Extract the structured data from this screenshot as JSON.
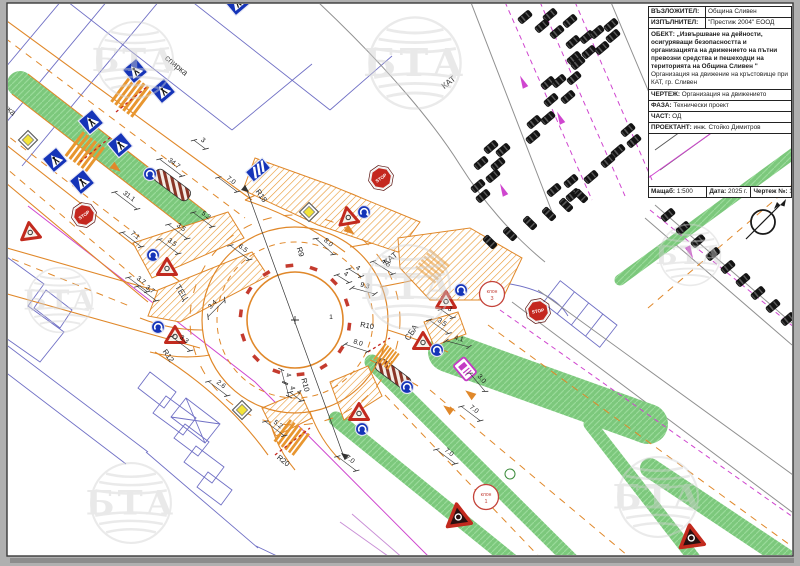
{
  "title_block": {
    "rows": [
      {
        "label": "ВЪЗЛОЖИТЕЛ:",
        "value": "Община Сливен"
      },
      {
        "label": "ИЗПЪЛНИТЕЛ:",
        "value": "\"Престиж 2004\" ЕООД"
      }
    ],
    "object_label": "ОБЕКТ:",
    "object_text": "„Извършване на дейности, осигуряващи безопасността и организацията на движението на пътни превозни средства и пешеходци на територията на Община Сливен \"",
    "object_sub": "Организация на движение на кръстовище при КАТ, гр. Сливен",
    "fields": [
      {
        "label": "ЧЕРТЕЖ:",
        "value": "Организация на движението"
      },
      {
        "label": "ФАЗА:",
        "value": "Технически проект"
      },
      {
        "label": "ЧАСТ:",
        "value": "ОД"
      },
      {
        "label": "ПРОЕКТАНТ:",
        "value": "инж. Стойко Димитров"
      }
    ],
    "footer": [
      {
        "label": "Мащаб:",
        "value": "1:500"
      },
      {
        "label": "Дата:",
        "value": "2025 г."
      },
      {
        "label": "Чертеж №:",
        "value": "1"
      }
    ]
  },
  "watermark": {
    "text": "БТА",
    "positions": [
      {
        "x": 135,
        "y": 60,
        "s": 1
      },
      {
        "x": 415,
        "y": 63,
        "s": 1.2
      },
      {
        "x": 408,
        "y": 287,
        "s": 1.1
      },
      {
        "x": 131,
        "y": 503,
        "s": 1.05
      },
      {
        "x": 658,
        "y": 497,
        "s": 1.05
      },
      {
        "x": 60,
        "y": 300,
        "s": 0.85
      },
      {
        "x": 690,
        "y": 255,
        "s": 0.8
      }
    ]
  },
  "drawing": {
    "stop_text": "STOP",
    "colors": {
      "orange": "#e0882a",
      "green": "#7cc87c",
      "blue_sign": "#1534b8",
      "magenta": "#cf46cf",
      "red": "#c4271f"
    },
    "labels": [
      {
        "t": "спирка",
        "x": 176,
        "y": 66,
        "r": 40,
        "k": "name"
      },
      {
        "t": "спирка",
        "x": 4,
        "y": 106,
        "r": 40,
        "k": "name"
      },
      {
        "t": "КАТ",
        "x": 449,
        "y": 83,
        "r": -38,
        "k": "name"
      },
      {
        "t": "КАТ",
        "x": 391,
        "y": 259,
        "r": -38,
        "k": "name"
      },
      {
        "t": "СБА",
        "x": 412,
        "y": 333,
        "r": -55,
        "k": "name"
      },
      {
        "t": "ТЕЦ",
        "x": 181,
        "y": 293,
        "r": 58,
        "k": "name"
      },
      {
        "t": "34.7",
        "x": 172,
        "y": 166,
        "r": 37,
        "k": "dim"
      },
      {
        "t": "3",
        "x": 201,
        "y": 143,
        "r": 37,
        "k": "dim"
      },
      {
        "t": "7.0",
        "x": 229,
        "y": 183,
        "r": 37,
        "k": "dim"
      },
      {
        "t": "31.1",
        "x": 127,
        "y": 199,
        "r": 37,
        "k": "dim"
      },
      {
        "t": "7.1",
        "x": 133,
        "y": 238,
        "r": 37,
        "k": "dim"
      },
      {
        "t": "3.5",
        "x": 170,
        "y": 245,
        "r": 37,
        "k": "dim"
      },
      {
        "t": "3.5",
        "x": 179,
        "y": 230,
        "r": 37,
        "k": "dim"
      },
      {
        "t": "5.2",
        "x": 204,
        "y": 218,
        "r": 37,
        "k": "dim"
      },
      {
        "t": "6.5",
        "x": 241,
        "y": 251,
        "r": 37,
        "k": "dim"
      },
      {
        "t": "3.7",
        "x": 139,
        "y": 283,
        "r": 37,
        "k": "dim"
      },
      {
        "t": "3.7",
        "x": 148,
        "y": 292,
        "r": 37,
        "k": "dim"
      },
      {
        "t": "3.3",
        "x": 182,
        "y": 342,
        "r": 37,
        "k": "dim"
      },
      {
        "t": "3.4",
        "x": 215,
        "y": 307,
        "r": -45,
        "k": "dim"
      },
      {
        "t": "8.0",
        "x": 326,
        "y": 245,
        "r": 42,
        "k": "dim"
      },
      {
        "t": "4",
        "x": 344,
        "y": 277,
        "r": 32,
        "k": "dim"
      },
      {
        "t": "4",
        "x": 356,
        "y": 271,
        "r": 32,
        "k": "dim"
      },
      {
        "t": "4.5",
        "x": 384,
        "y": 266,
        "r": 32,
        "k": "dim"
      },
      {
        "t": "9.3",
        "x": 364,
        "y": 289,
        "r": 15,
        "k": "dim"
      },
      {
        "t": "8.0",
        "x": 357,
        "y": 346,
        "r": 18,
        "k": "dim"
      },
      {
        "t": "4",
        "x": 285,
        "y": 376,
        "r": 75,
        "k": "dim"
      },
      {
        "t": "4",
        "x": 289,
        "y": 389,
        "r": 75,
        "k": "dim"
      },
      {
        "t": "5.2",
        "x": 276,
        "y": 427,
        "r": 37,
        "k": "dim"
      },
      {
        "t": "4",
        "x": 297,
        "y": 395,
        "r": 37,
        "k": "dim"
      },
      {
        "t": "2.6",
        "x": 219,
        "y": 387,
        "r": 37,
        "k": "dim"
      },
      {
        "t": "7.0",
        "x": 348,
        "y": 462,
        "r": 37,
        "k": "dim"
      },
      {
        "t": "7.0",
        "x": 447,
        "y": 455,
        "r": 37,
        "k": "dim"
      },
      {
        "t": "7.0",
        "x": 472,
        "y": 412,
        "r": 37,
        "k": "dim"
      },
      {
        "t": "3.0",
        "x": 479,
        "y": 381,
        "r": 50,
        "k": "dim"
      },
      {
        "t": "4.1",
        "x": 458,
        "y": 342,
        "r": 15,
        "k": "dim"
      },
      {
        "t": "3.5",
        "x": 440,
        "y": 325,
        "r": 35,
        "k": "dim"
      },
      {
        "t": "3",
        "x": 448,
        "y": 312,
        "r": 35,
        "k": "dim"
      },
      {
        "t": "R18",
        "x": 261,
        "y": 196,
        "r": 55,
        "k": "rad"
      },
      {
        "t": "R12",
        "x": 168,
        "y": 356,
        "r": 55,
        "k": "rad"
      },
      {
        "t": "R9",
        "x": 300,
        "y": 252,
        "r": 72,
        "k": "rad"
      },
      {
        "t": "R10",
        "x": 367,
        "y": 326,
        "r": 10,
        "k": "rad"
      },
      {
        "t": "R10",
        "x": 305,
        "y": 385,
        "r": 75,
        "k": "rad"
      },
      {
        "t": "R20",
        "x": 283,
        "y": 461,
        "r": 38,
        "k": "rad"
      },
      {
        "t": "1",
        "x": 331,
        "y": 317,
        "r": 0,
        "k": "plain"
      }
    ],
    "signs": [
      {
        "type": "ped",
        "x": 135,
        "y": 71,
        "r": -40
      },
      {
        "type": "ped",
        "x": 163,
        "y": 91,
        "r": -40
      },
      {
        "type": "ped",
        "x": 91,
        "y": 122,
        "r": -40
      },
      {
        "type": "ped",
        "x": 120,
        "y": 145,
        "r": -40
      },
      {
        "type": "ped",
        "x": 55,
        "y": 160,
        "r": -40
      },
      {
        "type": "ped",
        "x": 82,
        "y": 182,
        "r": -40
      },
      {
        "type": "ped",
        "x": 237,
        "y": 3,
        "r": -40
      },
      {
        "type": "stripe",
        "x": 258,
        "y": 170,
        "r": -40
      },
      {
        "type": "diamond",
        "x": 28,
        "y": 140,
        "r": 0
      },
      {
        "type": "diamond",
        "x": 309,
        "y": 212,
        "r": 0
      },
      {
        "type": "diamond",
        "x": 242,
        "y": 410,
        "r": 0
      },
      {
        "type": "stop",
        "x": 84,
        "y": 215,
        "r": -35
      },
      {
        "type": "stop",
        "x": 381,
        "y": 178,
        "r": -35
      },
      {
        "type": "stop",
        "x": 538,
        "y": 311,
        "r": -10
      },
      {
        "type": "yield",
        "x": 30,
        "y": 231,
        "r": -8
      },
      {
        "type": "yield",
        "x": 167,
        "y": 267,
        "r": 0
      },
      {
        "type": "yield",
        "x": 175,
        "y": 335,
        "r": 0
      },
      {
        "type": "yield",
        "x": 348,
        "y": 216,
        "r": -10
      },
      {
        "type": "yield",
        "x": 446,
        "y": 300,
        "r": 0
      },
      {
        "type": "yield",
        "x": 423,
        "y": 341,
        "r": 0
      },
      {
        "type": "yield",
        "x": 359,
        "y": 412,
        "r": 0
      },
      {
        "type": "bluecircle",
        "x": 150,
        "y": 174,
        "r": 0
      },
      {
        "type": "bluecircle",
        "x": 153,
        "y": 255,
        "r": 0
      },
      {
        "type": "bluecircle",
        "x": 158,
        "y": 327,
        "r": 0
      },
      {
        "type": "bluecircle",
        "x": 364,
        "y": 212,
        "r": 0
      },
      {
        "type": "bluecircle",
        "x": 461,
        "y": 290,
        "r": 0
      },
      {
        "type": "bluecircle",
        "x": 437,
        "y": 350,
        "r": 0
      },
      {
        "type": "bluecircle",
        "x": 362,
        "y": 429,
        "r": 0
      },
      {
        "type": "bluecircle",
        "x": 407,
        "y": 387,
        "r": 0
      },
      {
        "type": "warn",
        "x": 458,
        "y": 515,
        "r": -8
      },
      {
        "type": "warn",
        "x": 691,
        "y": 536,
        "r": -8
      },
      {
        "type": "msign",
        "x": 465,
        "y": 369,
        "r": -40
      },
      {
        "type": "klon",
        "x": 492,
        "y": 294,
        "l1": "клон",
        "l2": "3"
      },
      {
        "type": "klon",
        "x": 486,
        "y": 497,
        "l1": "клон",
        "l2": "1"
      }
    ],
    "cars": [
      {
        "x": 525,
        "y": 17,
        "r": -40
      },
      {
        "x": 550,
        "y": 15,
        "r": -40
      },
      {
        "x": 542,
        "y": 26,
        "r": -40
      },
      {
        "x": 570,
        "y": 21,
        "r": -40
      },
      {
        "x": 557,
        "y": 32,
        "r": -40
      },
      {
        "x": 587,
        "y": 37,
        "r": -40
      },
      {
        "x": 573,
        "y": 42,
        "r": -40
      },
      {
        "x": 597,
        "y": 32,
        "r": -40
      },
      {
        "x": 611,
        "y": 25,
        "r": -40
      },
      {
        "x": 613,
        "y": 36,
        "r": -40
      },
      {
        "x": 589,
        "y": 52,
        "r": -40
      },
      {
        "x": 574,
        "y": 58,
        "r": -40
      },
      {
        "x": 602,
        "y": 48,
        "r": -40
      },
      {
        "x": 578,
        "y": 63,
        "r": -40
      },
      {
        "x": 548,
        "y": 83,
        "r": -40
      },
      {
        "x": 559,
        "y": 81,
        "r": -40
      },
      {
        "x": 574,
        "y": 78,
        "r": -40
      },
      {
        "x": 551,
        "y": 100,
        "r": -40
      },
      {
        "x": 568,
        "y": 97,
        "r": -40
      },
      {
        "x": 534,
        "y": 122,
        "r": -40
      },
      {
        "x": 548,
        "y": 118,
        "r": -40
      },
      {
        "x": 533,
        "y": 137,
        "r": -40
      },
      {
        "x": 491,
        "y": 147,
        "r": -40
      },
      {
        "x": 503,
        "y": 150,
        "r": -40
      },
      {
        "x": 481,
        "y": 163,
        "r": -40
      },
      {
        "x": 498,
        "y": 164,
        "r": -40
      },
      {
        "x": 493,
        "y": 176,
        "r": -40
      },
      {
        "x": 478,
        "y": 186,
        "r": -40
      },
      {
        "x": 483,
        "y": 196,
        "r": -40
      },
      {
        "x": 554,
        "y": 190,
        "r": -40
      },
      {
        "x": 571,
        "y": 181,
        "r": -40
      },
      {
        "x": 628,
        "y": 130,
        "r": -40
      },
      {
        "x": 634,
        "y": 141,
        "r": -40
      },
      {
        "x": 618,
        "y": 151,
        "r": -40
      },
      {
        "x": 608,
        "y": 161,
        "r": -40
      },
      {
        "x": 591,
        "y": 177,
        "r": -40
      },
      {
        "x": 573,
        "y": 195,
        "r": -40
      },
      {
        "x": 490,
        "y": 242,
        "r": 45
      },
      {
        "x": 510,
        "y": 234,
        "r": 45
      },
      {
        "x": 530,
        "y": 223,
        "r": 45
      },
      {
        "x": 549,
        "y": 214,
        "r": 45
      },
      {
        "x": 566,
        "y": 205,
        "r": 45
      },
      {
        "x": 581,
        "y": 196,
        "r": 45
      },
      {
        "x": 668,
        "y": 215,
        "r": -40
      },
      {
        "x": 683,
        "y": 228,
        "r": -40
      },
      {
        "x": 698,
        "y": 241,
        "r": -40
      },
      {
        "x": 713,
        "y": 254,
        "r": -40
      },
      {
        "x": 728,
        "y": 267,
        "r": -40
      },
      {
        "x": 743,
        "y": 280,
        "r": -40
      },
      {
        "x": 758,
        "y": 293,
        "r": -40
      },
      {
        "x": 773,
        "y": 306,
        "r": -40
      },
      {
        "x": 788,
        "y": 319,
        "r": -40
      }
    ],
    "arrows_orange": [
      {
        "x": 116,
        "y": 168,
        "r": 37
      },
      {
        "x": 350,
        "y": 231,
        "r": 37
      },
      {
        "x": 470,
        "y": 394,
        "r": 217
      },
      {
        "x": 448,
        "y": 409,
        "r": 217
      }
    ],
    "arrows_magenta": [
      {
        "x": 523,
        "y": 82,
        "r": -115
      },
      {
        "x": 560,
        "y": 118,
        "r": -115
      },
      {
        "x": 503,
        "y": 190,
        "r": -115
      },
      {
        "x": 690,
        "y": 252,
        "r": 65
      }
    ]
  }
}
